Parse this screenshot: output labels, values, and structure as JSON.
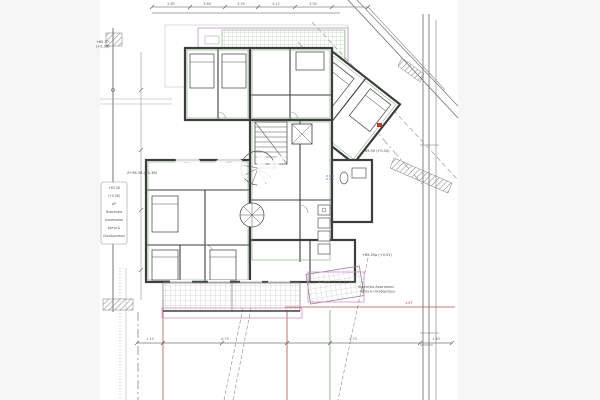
{
  "page": {
    "background": "#f6f6f6",
    "paper": "#ffffff"
  },
  "watermark": "ROK",
  "levels": {
    "boundary_top": "+65.37",
    "boundary_top2": "(+0.38)",
    "mid_left": "Z+65.38 (+0.38)",
    "road": "+65.00 (+0.10)",
    "southeast": "+65.45μ (+0.51)"
  },
  "notes": {
    "left_box": [
      "+65.38",
      "(+0.38)",
      "ΔΡ",
      "Ιδιοκτησία",
      "Αναστασίου",
      "Άρτια &",
      "Οικοδομήσιμη"
    ],
    "neighbor_line1": "Ιδιοκτησία Αναστασίου",
    "neighbor_line2": "Άρτια & Οικοδομήσιμη",
    "red_dim": "1.07"
  },
  "dims": {
    "top": [
      "2.85",
      "3.64",
      "3.55",
      "4.12",
      "3.90"
    ],
    "bottom": [
      "1.10",
      "4.75",
      "4.73",
      "1.40"
    ]
  },
  "colors": {
    "wall": "#3d3d3d",
    "partition_green": "#7fa77f",
    "grid_green": "#a6c4a0",
    "pergola_magenta": "#b585b5",
    "awning_pink": "#cf8fcb",
    "boundary_red": "#a8594e",
    "dimension_gray": "#8a8a8a",
    "marker_blue": "#8892c0",
    "marker_red": "#c0392b"
  }
}
